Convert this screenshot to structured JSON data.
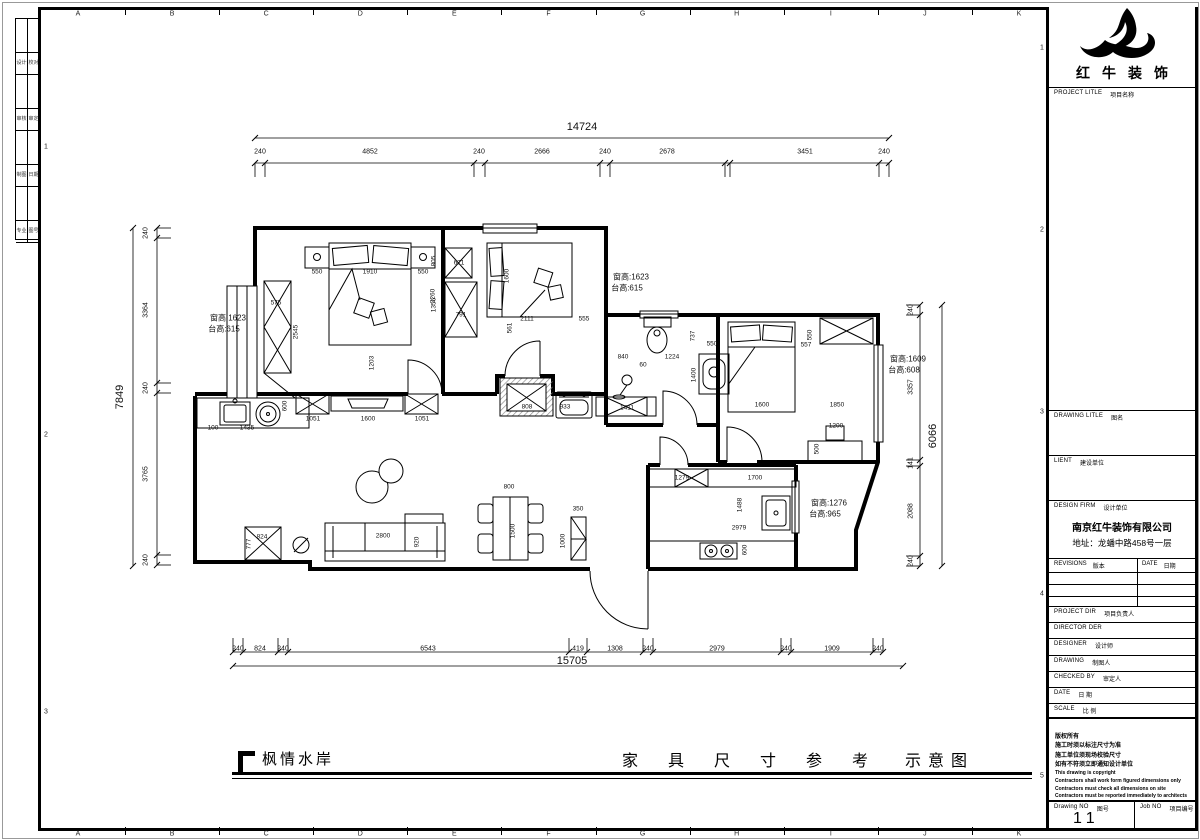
{
  "sheet": {
    "bg": "#ffffff",
    "line_color": "#000000"
  },
  "grid": {
    "top_letters": [
      "A",
      "B",
      "C",
      "D",
      "E",
      "F",
      "G",
      "H",
      "I",
      "J",
      "K"
    ],
    "left_numbers": [
      {
        "t": "1",
        "y": 147
      },
      {
        "t": "2",
        "y": 435
      },
      {
        "t": "3",
        "y": 712
      }
    ],
    "right_numbers": [
      {
        "t": "1",
        "y": 48
      },
      {
        "t": "2",
        "y": 230
      },
      {
        "t": "3",
        "y": 412
      },
      {
        "t": "4",
        "y": 594
      },
      {
        "t": "5",
        "y": 776
      }
    ]
  },
  "sign_strip": {
    "rows": [
      [
        "设计",
        "校对"
      ],
      [
        "审核",
        "审定"
      ],
      [
        "制图",
        "日期"
      ],
      [
        "专业",
        "图号"
      ]
    ]
  },
  "titlebar": {
    "project_name": "枫情水岸",
    "drawing_title": "家具尺寸参考",
    "drawing_title_suffix": "示意图"
  },
  "titleblock": {
    "brand": "红牛装饰",
    "rows": [
      {
        "en": "PROJECT LITLE",
        "cn": "项目名称"
      },
      {
        "en": "DRAWING LITLE",
        "cn": "图名"
      },
      {
        "en": "LIENT",
        "cn": "建设单位"
      },
      {
        "en": "DESIGN FIRM",
        "cn": "设计单位"
      },
      {
        "en": "REVISIONS",
        "cn": "版本"
      },
      {
        "en": "DATE",
        "cn": "日期"
      },
      {
        "en": "PROJECT DIR",
        "cn": "项目负责人"
      },
      {
        "en": "DIRECTOR DER",
        "cn": ""
      },
      {
        "en": "DESIGNER",
        "cn": "设计师"
      },
      {
        "en": "DRAWING",
        "cn": "制图人"
      },
      {
        "en": "CHECKED BY",
        "cn": "审定人"
      },
      {
        "en": "DATE",
        "cn": "日 期"
      },
      {
        "en": "SCALE",
        "cn": "比 例"
      },
      {
        "en": "Drawing NO",
        "cn": "图号"
      },
      {
        "en": "Job NO",
        "cn": "项目编号"
      }
    ],
    "firm_name": "南京红牛装饰有限公司",
    "firm_addr": "地址：龙蟠中路458号一层",
    "copyright_lines_cn": [
      "版权所有",
      "施工时须以标注尺寸为准",
      "施工单位须现场校验尺寸",
      "如有不符须立即通知设计单位"
    ],
    "copyright_lines_en": [
      "This drawing is copyright",
      "Contractors shall work form figured dimensions only",
      "Contractors must check all dimensions on site",
      "Contractors must be reported immediately to architects"
    ],
    "drawing_no": "11"
  },
  "plan": {
    "chains": [
      {
        "o": "h",
        "p": 138,
        "e": 0,
        "ticks": [
          255,
          889
        ]
      },
      {
        "o": "h",
        "p": 163,
        "e": 1,
        "ticks": [
          255,
          265,
          474,
          485,
          600,
          610,
          725,
          730,
          879,
          889
        ]
      },
      {
        "o": "v",
        "p": 133,
        "e": 0,
        "ticks": [
          228,
          566
        ]
      },
      {
        "o": "v",
        "p": 157,
        "e": 1,
        "ticks": [
          228,
          238,
          383,
          393,
          555,
          565
        ]
      },
      {
        "o": "v",
        "p": 920,
        "e": -1,
        "ticks": [
          305,
          315,
          460,
          466,
          556,
          566
        ]
      },
      {
        "o": "v",
        "p": 942,
        "e": 0,
        "ticks": [
          305,
          566
        ]
      },
      {
        "o": "h",
        "p": 652,
        "e": -1,
        "ticks": [
          233,
          243,
          278,
          288,
          569,
          587,
          643,
          653,
          781,
          791,
          873,
          883
        ]
      },
      {
        "o": "h",
        "p": 666,
        "e": 0,
        "ticks": [
          233,
          903
        ]
      }
    ],
    "labels": [
      {
        "t": "14724",
        "x": 582,
        "y": 127,
        "s": 11
      },
      {
        "t": "240",
        "x": 260,
        "y": 152
      },
      {
        "t": "4852",
        "x": 370,
        "y": 152
      },
      {
        "t": "240",
        "x": 479,
        "y": 152
      },
      {
        "t": "2666",
        "x": 542,
        "y": 152
      },
      {
        "t": "240",
        "x": 605,
        "y": 152
      },
      {
        "t": "2678",
        "x": 667,
        "y": 152
      },
      {
        "t": "3451",
        "x": 805,
        "y": 152
      },
      {
        "t": "240",
        "x": 884,
        "y": 152
      },
      {
        "t": "7849",
        "x": 120,
        "y": 397,
        "r": -90,
        "s": 11
      },
      {
        "t": "240",
        "x": 146,
        "y": 233,
        "r": -90
      },
      {
        "t": "3364",
        "x": 146,
        "y": 310,
        "r": -90
      },
      {
        "t": "240",
        "x": 146,
        "y": 388,
        "r": -90
      },
      {
        "t": "3765",
        "x": 146,
        "y": 474,
        "r": -90
      },
      {
        "t": "240",
        "x": 146,
        "y": 560,
        "r": -90
      },
      {
        "t": "240",
        "x": 911,
        "y": 310,
        "r": -90
      },
      {
        "t": "3357",
        "x": 911,
        "y": 387,
        "r": -90
      },
      {
        "t": "141",
        "x": 911,
        "y": 463,
        "r": -90
      },
      {
        "t": "2088",
        "x": 911,
        "y": 511,
        "r": -90
      },
      {
        "t": "240",
        "x": 911,
        "y": 561,
        "r": -90
      },
      {
        "t": "6066",
        "x": 933,
        "y": 436,
        "r": -90,
        "s": 11
      },
      {
        "t": "240",
        "x": 238,
        "y": 649
      },
      {
        "t": "824",
        "x": 260,
        "y": 649
      },
      {
        "t": "240",
        "x": 283,
        "y": 649
      },
      {
        "t": "6543",
        "x": 428,
        "y": 649
      },
      {
        "t": "419",
        "x": 578,
        "y": 649
      },
      {
        "t": "1308",
        "x": 615,
        "y": 649
      },
      {
        "t": "240",
        "x": 648,
        "y": 649
      },
      {
        "t": "2979",
        "x": 717,
        "y": 649
      },
      {
        "t": "240",
        "x": 786,
        "y": 649
      },
      {
        "t": "1909",
        "x": 832,
        "y": 649
      },
      {
        "t": "240",
        "x": 878,
        "y": 649
      },
      {
        "t": "15705",
        "x": 572,
        "y": 661,
        "s": 11
      },
      {
        "t": "550",
        "x": 317,
        "y": 272,
        "s": 6.5
      },
      {
        "t": "1910",
        "x": 370,
        "y": 272,
        "s": 6.5
      },
      {
        "t": "550",
        "x": 423,
        "y": 272,
        "s": 6.5
      },
      {
        "t": "2260",
        "x": 433,
        "y": 296,
        "r": -90,
        "s": 6.5
      },
      {
        "t": "575",
        "x": 276,
        "y": 303,
        "s": 6.5
      },
      {
        "t": "2545",
        "x": 296,
        "y": 332,
        "r": -90,
        "s": 6.5
      },
      {
        "t": "1203",
        "x": 372,
        "y": 363,
        "r": -90,
        "s": 6.5
      },
      {
        "t": "600",
        "x": 285,
        "y": 406,
        "r": -90,
        "s": 6.5
      },
      {
        "t": "100",
        "x": 213,
        "y": 428,
        "s": 6.5
      },
      {
        "t": "1435",
        "x": 247,
        "y": 428,
        "s": 6.5
      },
      {
        "t": "1051",
        "x": 313,
        "y": 419,
        "s": 6.5
      },
      {
        "t": "1600",
        "x": 368,
        "y": 419,
        "s": 6.5
      },
      {
        "t": "1051",
        "x": 422,
        "y": 419,
        "s": 6.5
      },
      {
        "t": "805",
        "x": 434,
        "y": 261,
        "r": -90,
        "s": 6.5
      },
      {
        "t": "671",
        "x": 459,
        "y": 263,
        "s": 6.5
      },
      {
        "t": "1356",
        "x": 434,
        "y": 305,
        "r": -90,
        "s": 6.5
      },
      {
        "t": "791",
        "x": 461,
        "y": 315,
        "s": 6.5
      },
      {
        "t": "1600",
        "x": 507,
        "y": 276,
        "r": -90,
        "s": 6.5
      },
      {
        "t": "2111",
        "x": 527,
        "y": 319,
        "s": 6.5
      },
      {
        "t": "555",
        "x": 584,
        "y": 319,
        "s": 6.5
      },
      {
        "t": "561",
        "x": 510,
        "y": 328,
        "r": -90,
        "s": 6.5
      },
      {
        "t": "840",
        "x": 623,
        "y": 357,
        "s": 6.5
      },
      {
        "t": "1224",
        "x": 672,
        "y": 357,
        "s": 6.5
      },
      {
        "t": "60",
        "x": 643,
        "y": 365,
        "s": 6.5
      },
      {
        "t": "737",
        "x": 693,
        "y": 336,
        "r": -90,
        "s": 6.5
      },
      {
        "t": "550",
        "x": 712,
        "y": 344,
        "s": 6.5
      },
      {
        "t": "1400",
        "x": 694,
        "y": 375,
        "r": -90,
        "s": 6.5
      },
      {
        "t": "808",
        "x": 527,
        "y": 407,
        "s": 6.5
      },
      {
        "t": "933",
        "x": 565,
        "y": 407,
        "s": 6.5
      },
      {
        "t": "1411",
        "x": 627,
        "y": 408,
        "s": 6.5
      },
      {
        "t": "550",
        "x": 810,
        "y": 335,
        "r": -90,
        "s": 6.5
      },
      {
        "t": "557",
        "x": 806,
        "y": 345,
        "s": 6.5
      },
      {
        "t": "1600",
        "x": 762,
        "y": 405,
        "s": 6.5
      },
      {
        "t": "1850",
        "x": 837,
        "y": 405,
        "s": 6.5
      },
      {
        "t": "1200",
        "x": 836,
        "y": 426,
        "s": 6.5
      },
      {
        "t": "500",
        "x": 817,
        "y": 449,
        "r": -90,
        "s": 6.5
      },
      {
        "t": "1279",
        "x": 682,
        "y": 478,
        "s": 6.5
      },
      {
        "t": "1700",
        "x": 755,
        "y": 478,
        "s": 6.5
      },
      {
        "t": "1488",
        "x": 740,
        "y": 505,
        "r": -90,
        "s": 6.5
      },
      {
        "t": "2979",
        "x": 739,
        "y": 528,
        "s": 6.5
      },
      {
        "t": "600",
        "x": 745,
        "y": 550,
        "r": -90,
        "s": 6.5
      },
      {
        "t": "800",
        "x": 509,
        "y": 487,
        "s": 6.5
      },
      {
        "t": "1500",
        "x": 513,
        "y": 531,
        "r": -90,
        "s": 6.5
      },
      {
        "t": "350",
        "x": 578,
        "y": 509,
        "s": 6.5
      },
      {
        "t": "1000",
        "x": 563,
        "y": 541,
        "r": -90,
        "s": 6.5
      },
      {
        "t": "2800",
        "x": 383,
        "y": 536,
        "s": 6.5
      },
      {
        "t": "920",
        "x": 417,
        "y": 542,
        "r": -90,
        "s": 6.5
      },
      {
        "t": "824",
        "x": 262,
        "y": 537,
        "s": 6.5
      },
      {
        "t": "777",
        "x": 249,
        "y": 544,
        "r": -90,
        "s": 6.5
      }
    ],
    "annotations": [
      {
        "t": "窗高:1623",
        "x": 228,
        "y": 318
      },
      {
        "t": "台高:615",
        "x": 224,
        "y": 329
      },
      {
        "t": "窗高:1623",
        "x": 631,
        "y": 277
      },
      {
        "t": "台高:615",
        "x": 627,
        "y": 288
      },
      {
        "t": "窗高:1609",
        "x": 908,
        "y": 359
      },
      {
        "t": "台高:608",
        "x": 904,
        "y": 370
      },
      {
        "t": "窗高:1276",
        "x": 829,
        "y": 503
      },
      {
        "t": "台高:965",
        "x": 825,
        "y": 514
      }
    ]
  }
}
